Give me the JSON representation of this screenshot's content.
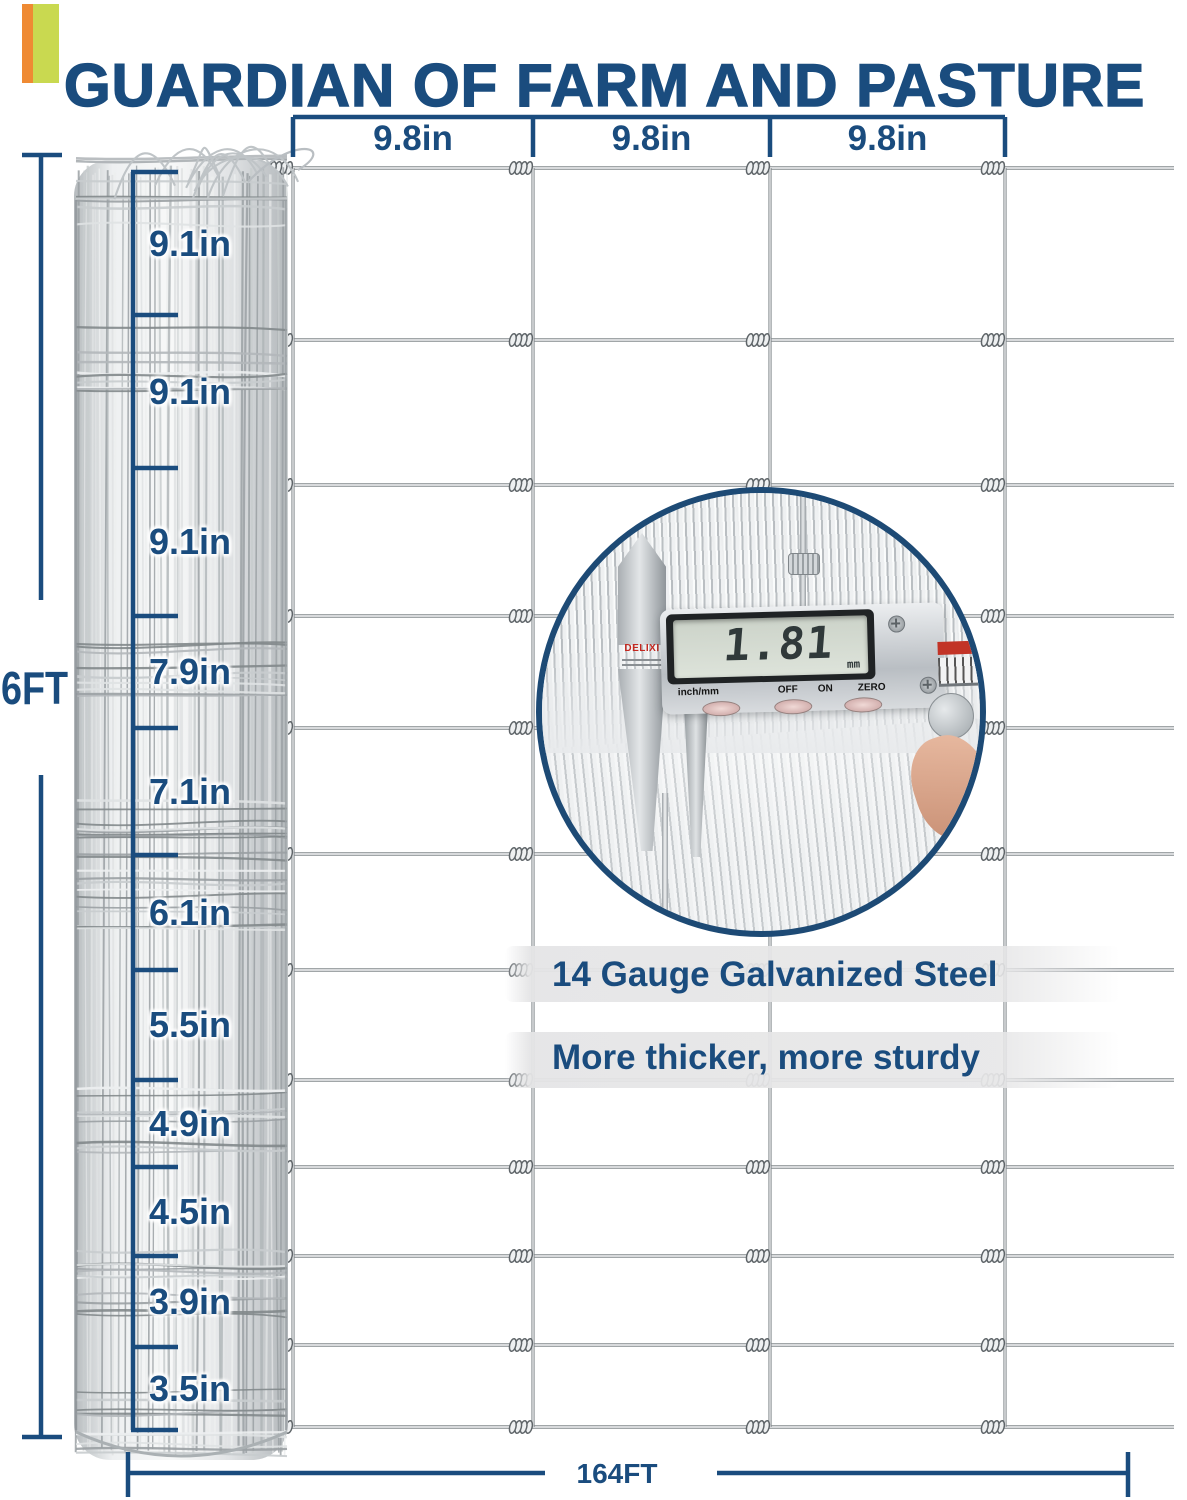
{
  "header": {
    "title": "GUARDIAN OF FARM AND PASTURE"
  },
  "colors": {
    "navy": "#1a4c7e",
    "accent_orange": "#ef8a33",
    "accent_green": "#c9d950",
    "wire_dark": "#82888c",
    "wire_light": "#f5f6f7"
  },
  "top_dimension": {
    "labels": [
      "9.8in",
      "9.8in",
      "9.8in"
    ]
  },
  "left_dimension": {
    "height_label": "6FT",
    "segments": [
      "9.1in",
      "9.1in",
      "9.1in",
      "7.9in",
      "7.1in",
      "6.1in",
      "5.5in",
      "4.9in",
      "4.5in",
      "3.9in",
      "3.5in"
    ]
  },
  "bottom_dimension": {
    "label": "164FT"
  },
  "features": {
    "line1": "14 Gauge Galvanized Steel",
    "line2": "More thicker, more sturdy"
  },
  "inset": {
    "brand": "DELIXI",
    "display_value": "1.81",
    "display_unit": "mm",
    "button_labels": [
      "inch/mm",
      "OFF",
      "ON",
      "ZERO"
    ]
  }
}
